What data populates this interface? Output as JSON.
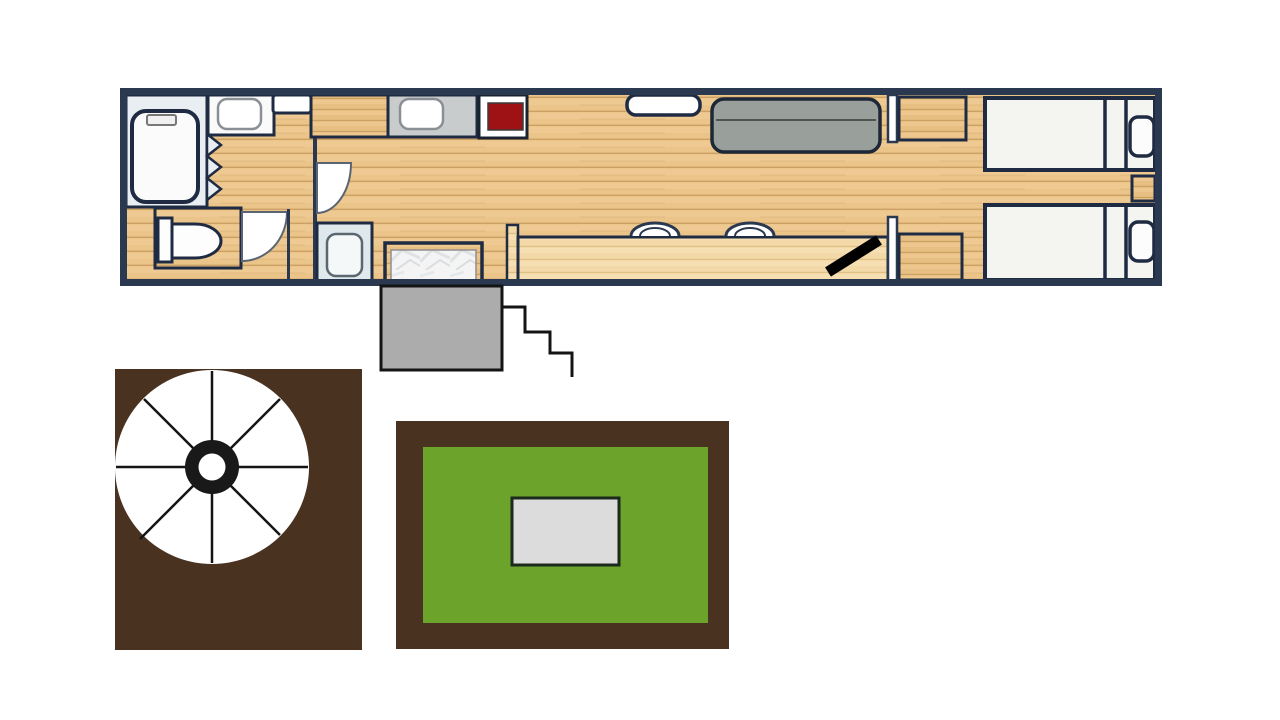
{
  "canvas": {
    "width": 1280,
    "height": 720,
    "background": "#ffffff"
  },
  "colors": {
    "outline_navy": "#2b3950",
    "outline_dark": "#1f2b42",
    "wood_floor": "#eac489",
    "wood_counter": "#f2d9a7",
    "wood_cabinet": "#e8bf82",
    "tub_room_blue": "#e9eef2",
    "sink_room_blue": "#dfe8ec",
    "counter_gray": "#c9cccd",
    "stove_red": "#9e1216",
    "sofa_gray": "#99a09b",
    "fixture_white": "#fdfdfd",
    "bed_white": "#f4f4f1",
    "marble_white": "#f4f4f4",
    "porch_gray": "#acacac",
    "deck_brown": "#4a3221",
    "lawn_green": "#6ba32b",
    "table_gray": "#dcdcdc",
    "stairs_black": "#141414",
    "door_black": "#000000"
  },
  "diagram": {
    "type": "floor-plan",
    "description": "Long narrow dwelling floor plan (bus / tiny-home conversion) plus exterior features: gray entry landing with step stairs, brown deck with round umbrella table, and a brown-bordered green lawn with a gray table.",
    "rooms": [
      "bathroom-with-tub",
      "toilet-room",
      "hallway",
      "kitchen",
      "living-area",
      "bar-area",
      "bedroom-twin-beds"
    ],
    "fixtures": [
      "bathtub",
      "tub-faucet",
      "shower-curtain-zigzag",
      "vanity-sink",
      "wall-box",
      "toilet",
      "door-swing-toilet",
      "door-swing-hall",
      "bathroom-sink",
      "kitchen-cabinet",
      "kitchen-counter-sink",
      "stove",
      "marble-island-counter",
      "half-wall",
      "breakfast-bar-counter",
      "bar-stool-1",
      "bar-stool-2",
      "window",
      "sofa",
      "wall-pocket-top",
      "wardrobe-top-right",
      "wall-pocket-bottom",
      "wardrobe-bottom-right",
      "open-door-black",
      "twin-bed-top",
      "pillow-top",
      "nightstand",
      "twin-bed-bottom",
      "pillow-bottom",
      "entry-landing",
      "stairs",
      "deck",
      "umbrella-table",
      "lawn",
      "garden-table"
    ]
  }
}
